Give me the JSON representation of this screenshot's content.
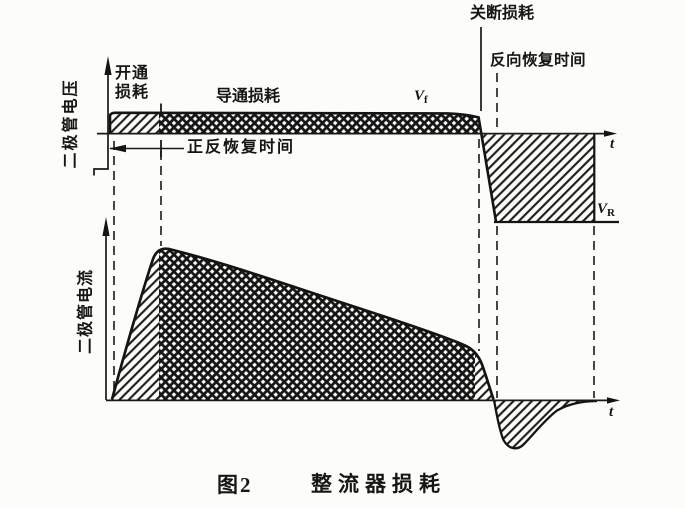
{
  "caption": {
    "number": "图2",
    "title": "整流器损耗"
  },
  "voltage_plot": {
    "axis_label": "二极管电压",
    "time_label": "t",
    "labels": {
      "turn_on_loss": "开通损耗",
      "conduction_loss": "导通损耗",
      "turn_off_loss": "关断损耗",
      "forward_recovery_time": "正反恢复时间",
      "reverse_recovery_time": "反向恢复时间"
    },
    "vf": {
      "base": "V",
      "sub": "f"
    },
    "vr": {
      "base": "V",
      "sub": "R"
    }
  },
  "current_plot": {
    "axis_label": "二极管电流",
    "time_label": "t"
  },
  "colors": {
    "ink": "#161616",
    "paper": "#fcfcf9"
  }
}
